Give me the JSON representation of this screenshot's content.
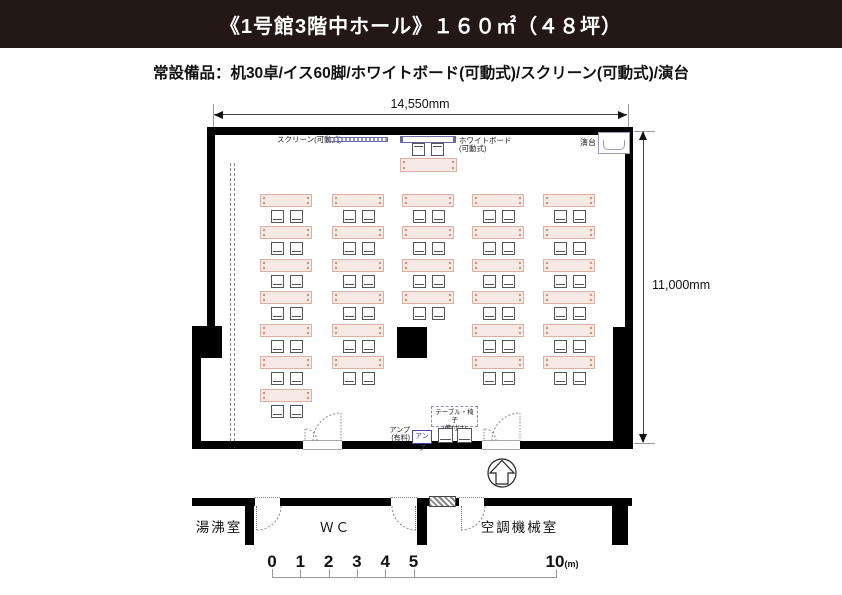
{
  "header": {
    "title": "《1号館3階中ホール》１６０㎡（４８坪）"
  },
  "equipment_note": "常設備品：机30卓/イス60脚/ホワイトボード(可動式)/スクリーン(可動式)/演台",
  "dimensions": {
    "width": "14,550mm",
    "height": "11,000mm"
  },
  "fixtures": {
    "screen_label": "スクリーン(可動式)",
    "whiteboard_label_1": "ホワイトボード",
    "whiteboard_label_2": "(可動式)",
    "podium_label": "演台",
    "amp_label_1": "アンプ",
    "amp_label_2": "(有料)",
    "amp_box_label": "アンプ",
    "fixed_note_line1": "テーブル・椅子",
    "fixed_note_line2": "(備付け)"
  },
  "furniture": {
    "desk_count": 30,
    "chair_count": 60,
    "columns": [
      {
        "x": 260,
        "rows": 7
      },
      {
        "x": 332,
        "rows": 6
      },
      {
        "x": 402,
        "rows": 4
      },
      {
        "x": 472,
        "rows": 6
      },
      {
        "x": 543,
        "rows": 6
      }
    ],
    "row_y": [
      194,
      226,
      259,
      291,
      324,
      356,
      389
    ],
    "front_table": {
      "x": 400,
      "y": 158
    }
  },
  "annex_rooms": {
    "room1": "湯沸室",
    "room2": "ＷＣ",
    "room3": "空調機械室"
  },
  "scale_bar": {
    "ticks": [
      "0",
      "1",
      "2",
      "3",
      "4",
      "5"
    ],
    "far_tick": "10",
    "unit": "(m)"
  },
  "colors": {
    "header_bg": "#231815",
    "wall": "#000000",
    "table_fill": "#f7eae4",
    "table_border": "#ddb0a4",
    "fixture_blue": "#6a6aa5"
  }
}
